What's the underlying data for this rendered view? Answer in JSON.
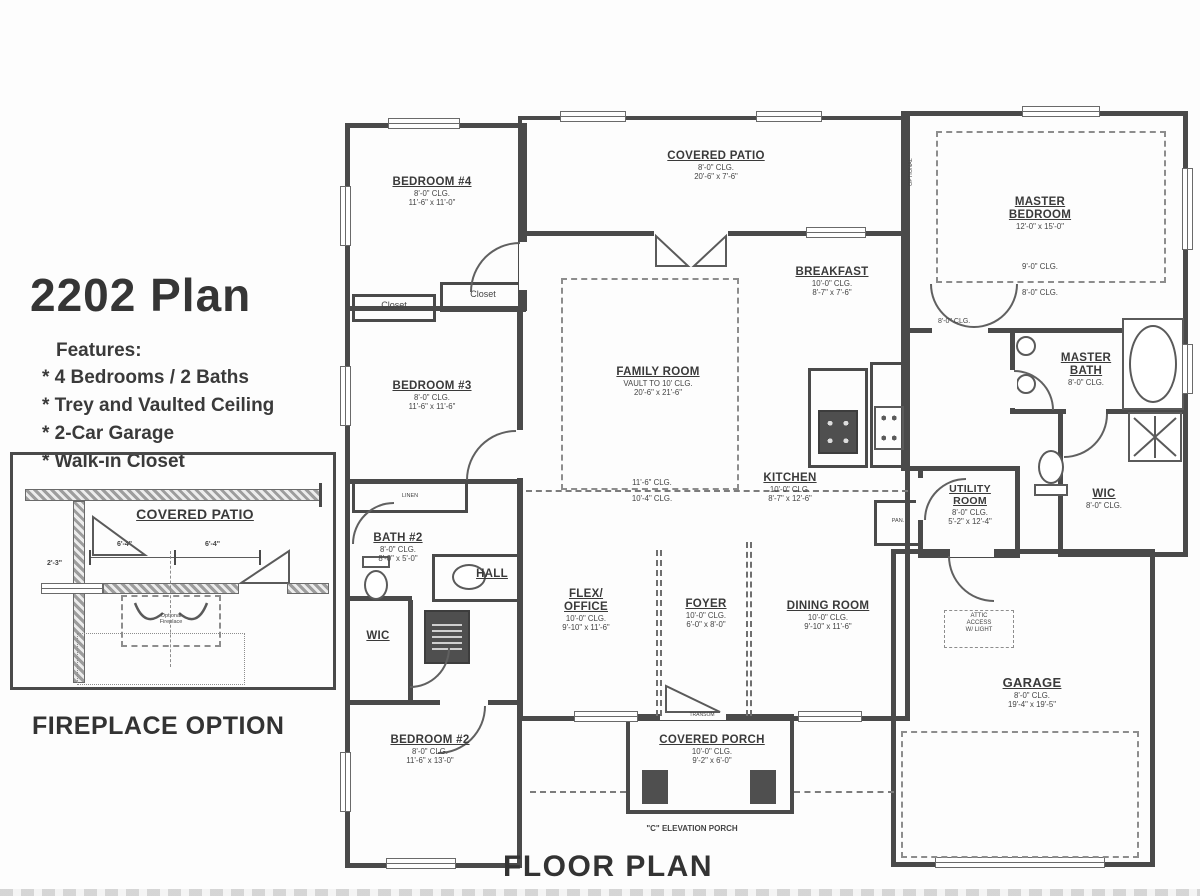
{
  "colors": {
    "ink": "#4a4a4a",
    "paper": "#fdfdfd"
  },
  "title_block": {
    "title": "2202 Plan",
    "features_heading": "Features:",
    "features": [
      "* 4 Bedrooms / 2 Baths",
      "* Trey and Vaulted Ceiling",
      "* 2-Car Garage",
      "* Walk-in Closet"
    ]
  },
  "inset": {
    "room": "COVERED PATIO",
    "dim_left": "6'-4\"",
    "dim_right": "6'-4\"",
    "dim_corner": "2'-3\"",
    "fireplace_line1": "Optional",
    "fireplace_line2": "Fireplace",
    "caption": "FIREPLACE OPTION"
  },
  "rooms": {
    "bedroom4": {
      "name": "BEDROOM #4",
      "clg": "8'-0\" CLG.",
      "dims": "11'-6\" x 11'-0\""
    },
    "covered_patio": {
      "name": "COVERED PATIO",
      "clg": "8'-0\" CLG.",
      "dims": "20'-6\" x 7'-6\""
    },
    "master_bedroom": {
      "name": "MASTER BEDROOM",
      "dims": "12'-0\" x 15'-0\"",
      "tray_clg": "9'-0\" CLG.",
      "base_clg": "8'-0\" CLG."
    },
    "breakfast": {
      "name": "BREAKFAST",
      "clg": "10'-0\" CLG.",
      "dims": "8'-7\" x 7'-6\""
    },
    "family_room": {
      "name": "FAMILY ROOM",
      "clg": "VAULT TO 10' CLG.",
      "dims": "20'-6\" x 21'-6\"",
      "clg_upper": "11'-6\" CLG.",
      "clg_lower": "10'-4\" CLG."
    },
    "bedroom3": {
      "name": "BEDROOM #3",
      "clg": "8'-0\" CLG.",
      "dims": "11'-6\" x 11'-6\""
    },
    "kitchen": {
      "name": "KITCHEN",
      "clg": "10'-0\" CLG.",
      "dims": "8'-7\" x 12'-6\""
    },
    "utility": {
      "name": "UTILITY ROOM",
      "clg": "8'-0\" CLG.",
      "dims": "5'-2\" x 12'-4\""
    },
    "master_bath": {
      "name": "MASTER BATH",
      "clg": "8'-0\" CLG."
    },
    "wic_master": {
      "name": "WIC",
      "clg": "8'-0\" CLG."
    },
    "bath2": {
      "name": "BATH #2",
      "clg": "8'-0\" CLG.",
      "dims": "8'-0\" x 5'-0\""
    },
    "hall": {
      "name": "HALL"
    },
    "wic_hall": {
      "name": "WIC"
    },
    "flex_office": {
      "name": "FLEX/ OFFICE",
      "clg": "10'-0\" CLG.",
      "dims": "9'-10\" x 11'-6\""
    },
    "foyer": {
      "name": "FOYER",
      "clg": "10'-0\" CLG.",
      "dims": "6'-0\" x 8'-0\""
    },
    "dining": {
      "name": "DINING ROOM",
      "clg": "10'-0\" CLG.",
      "dims": "9'-10\" x 11'-6\""
    },
    "bedroom2": {
      "name": "BEDROOM #2",
      "clg": "8'-0\" CLG.",
      "dims": "11'-6\" x 13'-0\""
    },
    "covered_porch": {
      "name": "COVERED PORCH",
      "clg": "10'-0\" CLG.",
      "dims": "9'-2\" x 6'-0\""
    },
    "garage": {
      "name": "GARAGE",
      "clg": "8'-0\" CLG.",
      "dims": "19'-4\" x 19'-5\""
    }
  },
  "labels": {
    "closet": "Closet",
    "linen": "LINEN",
    "pan": "PAN.",
    "transom": "TRANSOM",
    "attic_line1": "ATTIC",
    "attic_line2": "ACCESS",
    "attic_line3": "W/ LIGHT",
    "c_elevation": "\"C\" ELEVATION PORCH",
    "optional": "OPTIONAL",
    "master_hall_clg": "8'-0\" CLG."
  },
  "footer": {
    "title": "FLOOR PLAN"
  }
}
